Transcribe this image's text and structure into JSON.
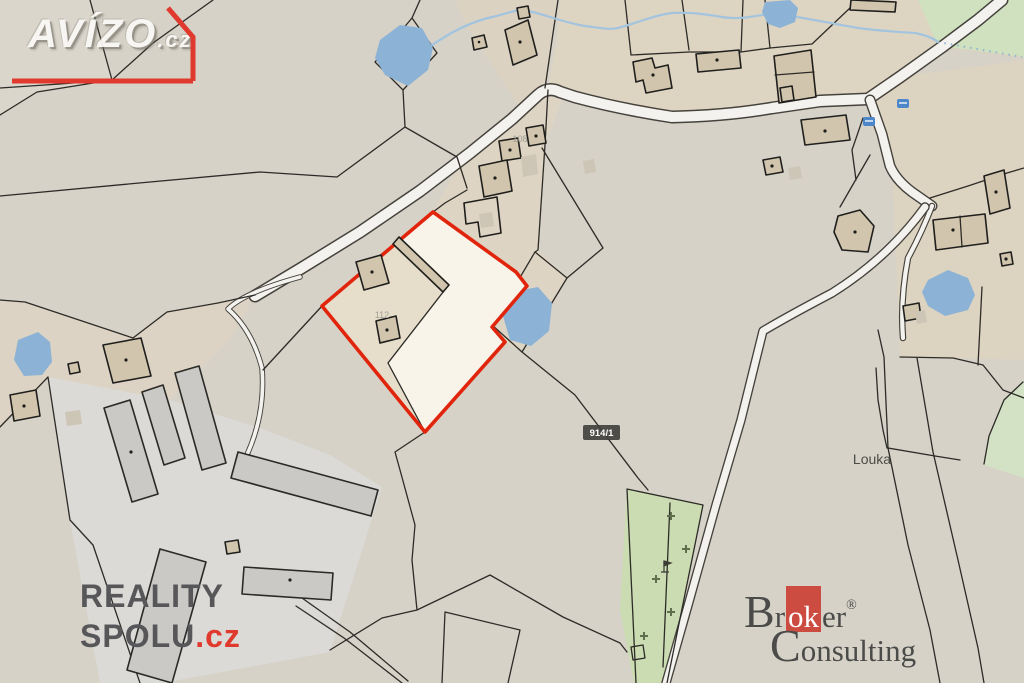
{
  "labels": {
    "parcel_108": "108",
    "parcel_112": "112",
    "parcel_914_badge": "914/1",
    "place_louka": "Louka"
  },
  "watermarks": {
    "avizo": {
      "name": "AVÍZO",
      "tld": ".cz"
    },
    "reality_spolu": {
      "line1": "REALITY",
      "line2": "SPOLU",
      "tld": ".cz"
    },
    "broker_consulting": {
      "b_initial": "B",
      "word1_pre": "r",
      "word1_box": "ok",
      "word1_post": "er",
      "registered": "®",
      "c_initial": "C",
      "word2_rest": "onsulting"
    }
  },
  "icons": {
    "bus": "bus-icon",
    "tree": "tree-icon",
    "flag": "flag-icon"
  },
  "colors": {
    "highlight_red": "#e1250c",
    "water_blue": "#8cb2d6",
    "road_white": "#f4f2ee",
    "badge_bg": "#3f3e3c",
    "brand_red": "#cd4c41",
    "logo_red": "#e0392e",
    "line_dark": "#2d2b27",
    "building_fill": "#d2c5ad"
  }
}
